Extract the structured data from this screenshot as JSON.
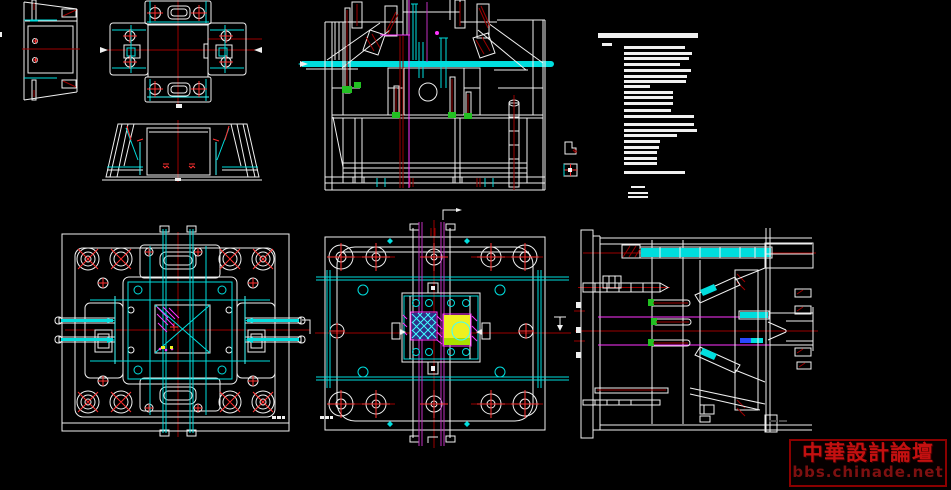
{
  "colors": {
    "bg": "#000000",
    "line": "#f0f0f0",
    "cyan": "#00dede",
    "cyanB": "#40ffff",
    "red": "#ff3030",
    "darkRed": "#9c0000",
    "magenta": "#ff35ff",
    "purple": "#c030c0",
    "green": "#22c022",
    "yellow": "#eef020",
    "lime": "#a8e000",
    "blue": "#2848ff",
    "hatchBlue": "#2e2e88",
    "wmRed": "#c41010",
    "wmDark": "#7e1010",
    "wmBorder": "#8b0000"
  },
  "drawing": {
    "notes": {
      "bars": [
        [
          38,
          5,
          100,
          5
        ],
        [
          42,
          15,
          10,
          3
        ],
        [
          64,
          18,
          61,
          3
        ],
        [
          64,
          24,
          68,
          3
        ],
        [
          64,
          29,
          65,
          3
        ],
        [
          64,
          35,
          56,
          3
        ],
        [
          64,
          41,
          67,
          3
        ],
        [
          64,
          47,
          63,
          3
        ],
        [
          64,
          52,
          62,
          3
        ],
        [
          64,
          57,
          26,
          3
        ],
        [
          64,
          63,
          49,
          3
        ],
        [
          64,
          68,
          49,
          3
        ],
        [
          64,
          74,
          49,
          3
        ],
        [
          64,
          81,
          47,
          3
        ],
        [
          64,
          87,
          70,
          3
        ],
        [
          64,
          95,
          70,
          3
        ],
        [
          64,
          101,
          73,
          3
        ],
        [
          64,
          106,
          53,
          3
        ],
        [
          64,
          112,
          36,
          3
        ],
        [
          64,
          118,
          35,
          3
        ],
        [
          64,
          123,
          33,
          3
        ],
        [
          64,
          129,
          33,
          3
        ],
        [
          64,
          134,
          33,
          3
        ],
        [
          64,
          143,
          61,
          3
        ],
        [
          71,
          158,
          14,
          2
        ],
        [
          68,
          164,
          20,
          2
        ],
        [
          68,
          168,
          20,
          2
        ]
      ]
    }
  },
  "watermark": {
    "line1": "中華設計論壇",
    "line2": "bbs.chinade.net"
  }
}
